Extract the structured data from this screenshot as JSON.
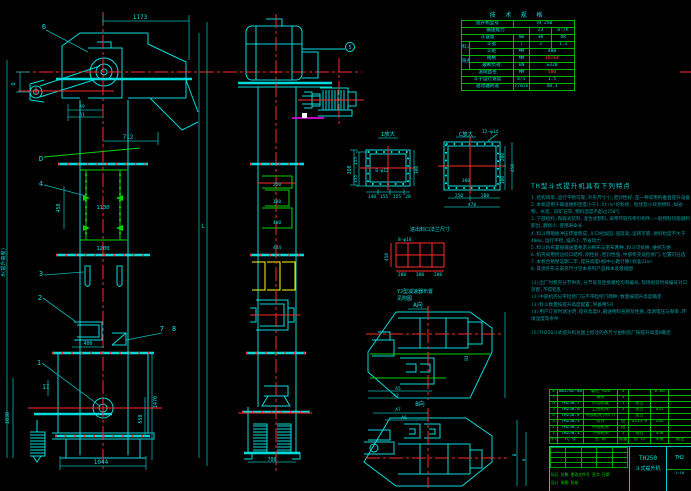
{
  "front": {
    "balloon_1": "1",
    "balloon_2": "2",
    "balloon_3": "3",
    "balloon_4": "4",
    "balloon_6": "6",
    "balloon_7": "7",
    "balloon_8": "8",
    "label_d": "D",
    "label_sec": "II",
    "dim_1173": "1173",
    "dim_712": "712",
    "dim_a9": "A9",
    "dim_a1": "A1",
    "dim_q": "Q",
    "dim_450": "450",
    "dim_1130": "1130",
    "dim_1200": "1200",
    "dim_400": "400",
    "dim_1030": "1030",
    "dim_1470": "1470",
    "dim_550": "550",
    "dim_1044": "1044",
    "dim_h": "H(提升高度)",
    "dim_l": "L"
  },
  "side": {
    "balloon_5": "5",
    "dim_360": "360",
    "dim_250": "250",
    "dim_180": "180",
    "dim_400": "400",
    "dim_444": "444",
    "dim_700": "700"
  },
  "flange_i": {
    "label": "I放大",
    "hole": "8-φ12",
    "left_top": "155",
    "left_bot": "155",
    "right": "300",
    "b1": "140",
    "b2": "155",
    "b3": "155",
    "b4": "20"
  },
  "flange_c": {
    "label": "C放大",
    "hole": "12-φ14",
    "inner": "300",
    "b1": "250",
    "b2": "200",
    "total": "470",
    "r1": "200",
    "r2": "100",
    "r_total": "450"
  },
  "details": {
    "flange_caption": "进出料口法兰尺寸",
    "grid_hole": "8-φ18",
    "grid_left": "450",
    "g1": "200",
    "g2": "300",
    "g3": "200",
    "note1": "YJ型减速器布置",
    "note2": "见附图",
    "view_a": "A向",
    "view_b": "B向",
    "a5": "A5",
    "a3": "A3",
    "b1": "B1",
    "a7": "A7",
    "a6": "A6",
    "b": "B",
    "a": "a"
  },
  "spec": {
    "title": "技 术 规 格",
    "r1l": "提升机型号",
    "r1v": "TH 250",
    "r2l": "输送能力",
    "r2v": "23",
    "r2u": "m³/h",
    "r3l": "斗容量",
    "r3u": "mm",
    "r3a": "30",
    "r3b": "48",
    "grp1": "料斗",
    "r4l": "斗宽",
    "r4u": "l",
    "r4a": "3",
    "r4b": "1.3",
    "r5l": "斗距",
    "r5u": "MM",
    "r5v": "480",
    "grp2": "链条",
    "r6l": "规格",
    "r6u": "MM",
    "r6v": "18×64",
    "r7l": "破断负荷",
    "r7u": "kN",
    "r7v": "≥320",
    "r8l": "滚筒直径",
    "r8u": "MM",
    "r8v": "500",
    "r9l": "斗子运行速度",
    "r9u": "m/s",
    "r9v": "1.5",
    "r10l": "驱动轴转速",
    "r10u": "r/min",
    "r10v": "48.3"
  },
  "notes": {
    "heading": "TH型斗式提升机具有下列特点",
    "lines": [
      "1.结构简单,运行平稳可靠,外形尺寸小,密封性好,是一种常用的垂直提升设备",
      "2.本机适用于输送堆积密度小于1.5t/m³的粉状、粒状及小块状物料,如谷物、水泥、碎矿石等,物料温度不超过250℃",
      "3.下部给料,掏取式装料,混合式卸料,采用环链作牵引构件,一般物料均能顺利卸出,磨损小,使用寿命长",
      "4.料斗用钢板冲压焊接而成,斗口经加固,强度高,运转可靠,进料粒度不大于40mm,运行平稳,噪声小,节省动力",
      "5.料斗的布置按输送量要求分稀布与密布两种,料斗可拆换,维修方便",
      "6.机壳采用折边咬口结构,刚性好,密封性强,中部机壳设检修门,位置可任选",
      "7.本机合格保证期二年,提升高度H按中心距计算(标准31m)",
      "8.其他外形与安装尺寸见本系列产品样本及基础图",
      "",
      "(1)出厂时机壳分节供货,分节处及连接螺栓均有编号,现场组装时按编号对口装配,不得错乱",
      "(2)中部机壳分带检修门与不带检修门两种,数量按提升高度确定",
      "(3)料斗数量按提升高度配置,另备用5只",
      "(4)用户订货时请注明:提升高度H,输送物料名称及性质,电源电压与频率,环境温度等条件",
      "",
      "(5)TH250斗式提升机总图上标注的各尺寸由制造厂按提升高度H确定"
    ]
  },
  "bom": {
    "header": [
      "序号",
      "代  号",
      "名  称",
      "数量",
      "材 料",
      "单重",
      "备注"
    ],
    "rows": [
      [
        "8",
        "GB5782-86",
        "螺栓 M20",
        "4",
        "",
        "0.06",
        ""
      ],
      [
        "7",
        "",
        "链条",
        "1",
        "",
        "",
        ""
      ],
      [
        "6",
        "TH250.7",
        "传动装置",
        "1",
        "组合",
        "",
        ""
      ],
      [
        "5",
        "TH250.6",
        "上部机壳",
        "1",
        "组合",
        "635",
        ""
      ],
      [
        "4",
        "TH250.4",
        "中部机壳(带门)",
        "",
        "组合",
        "",
        ""
      ],
      [
        "3",
        "TH250.3",
        "料斗",
        "组",
        "Q235-A",
        "204",
        ""
      ],
      [
        "2",
        "TH250.2",
        "中部机壳",
        "组",
        "",
        "",
        ""
      ],
      [
        "1",
        "TH250.1",
        "下部机壳",
        "1",
        "组合",
        "450",
        ""
      ]
    ]
  },
  "title_block": {
    "model": "TH250",
    "name": "斗式提升机",
    "code": "TH2",
    "rev_line": "标记 处数 更改文件号 签字 日期",
    "roles_line": "设计  制图  校核",
    "scale": "1:10"
  },
  "colors": {
    "background": "#000000",
    "line_cyan": "#00dcdc",
    "line_green": "#00d400",
    "line_red": "#ff2a2a",
    "line_yellow": "#ffff00",
    "line_magenta": "#ff00ff",
    "notes_teal": "#009fa5"
  }
}
